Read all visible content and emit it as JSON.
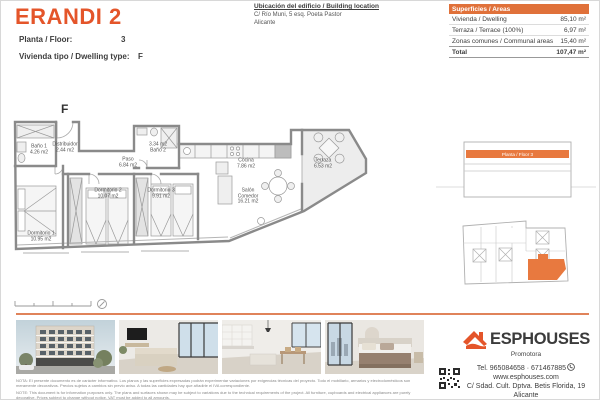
{
  "colors": {
    "accent": "#e4552a",
    "table_header_bg": "#e0713a",
    "divider_rule": "#e0835a",
    "plan_highlight": "#e8793f"
  },
  "header": {
    "title": "ERANDI 2",
    "floor_label": "Planta / Floor:",
    "floor_value": "3",
    "type_label": "Vivienda tipo / Dwelling type:",
    "type_value": "F"
  },
  "location": {
    "title": "Ubicación del edificio / Building location",
    "line1": "C/ Río Muni, 5 esq. Poeta Pastor",
    "line2": "Alicante"
  },
  "areas_table": {
    "header": "Superficies / Areas",
    "rows": [
      {
        "label": "Vivienda / Dwelling",
        "value": "85,10 m²"
      },
      {
        "label": "Terraza / Terrace (100%)",
        "value": "6,97 m²"
      },
      {
        "label": "Zonas comunes / Communal areas",
        "value": "15,40 m²"
      }
    ],
    "total": {
      "label": "Total",
      "value": "107,47 m²"
    }
  },
  "floorplan": {
    "unit_label": "F",
    "rooms": [
      {
        "lines": [
          "Baño 1",
          "4.26 m2"
        ]
      },
      {
        "lines": [
          "Distribuidor",
          "2.44 m2"
        ]
      },
      {
        "lines": [
          "Paso",
          "6.84 m2"
        ]
      },
      {
        "lines": [
          "3.34 m2",
          "Baño 2"
        ]
      },
      {
        "lines": [
          "Dormitorio 1",
          "10.95 m2"
        ]
      },
      {
        "lines": [
          "Dormitorio 2",
          "10.07 m2"
        ]
      },
      {
        "lines": [
          "Dormitorio 3",
          "9.91 m2"
        ]
      },
      {
        "lines": [
          "Cocina",
          "7.86 m2"
        ]
      },
      {
        "lines": [
          "Salón",
          "Comedor",
          "16.21 m2"
        ]
      },
      {
        "lines": [
          "Terraza",
          "6.53 m2"
        ]
      }
    ]
  },
  "elevation": {
    "floor_band": "Planta / Floor 3"
  },
  "notes": {
    "es": "NOTA: El presente documento es de carácter informativo. Los planos y las superficies expresadas podrán experimentar variaciones por exigencias técnicas del proyecto. Todo el mobiliario, armarios y electrodomésticos son meramente decorativos. Precios sujetos a cambios sin previo aviso. A todas las cantidades hay que añadirle el IVA correspondiente.",
    "en": "NOTE: This document is for information purposes only. The plans and surfaces shown may be subject to variations due to the technical requirements of the project. All furniture, cupboards and electrical appliances are purely decorative. Prices subject to change without notice. VAT must be added to all amounts."
  },
  "brand": {
    "name": "ESPHOUSES",
    "subtitle": "Promotora",
    "phone": "Tel. 965084658 · 671467885",
    "website": "www.esphouses.com",
    "address": "C/ Sdad. Cult. Dptva. Betis Florida, 19",
    "city": "Alicante"
  }
}
